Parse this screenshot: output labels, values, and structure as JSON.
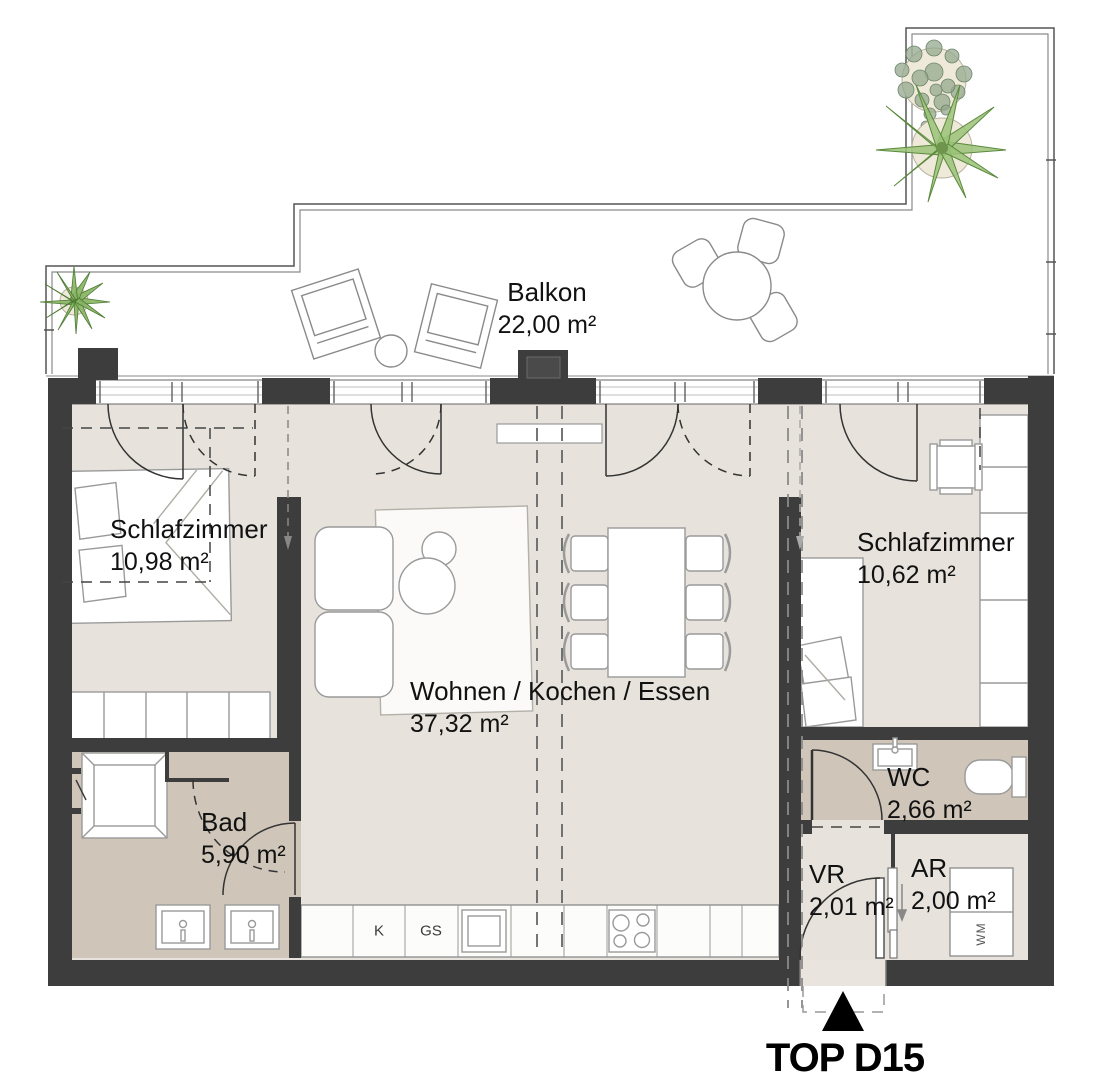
{
  "plan": {
    "unit_label": "TOP D15",
    "rooms": {
      "balkon": {
        "name": "Balkon",
        "area": "22,00 m²"
      },
      "schlafzimmer1": {
        "name": "Schlafzimmer",
        "area": "10,98 m²"
      },
      "wohnen": {
        "name": "Wohnen / Kochen / Essen",
        "area": "37,32 m²"
      },
      "schlafzimmer2": {
        "name": "Schlafzimmer",
        "area": "10,62 m²"
      },
      "bad": {
        "name": "Bad",
        "area": "5,90 m²"
      },
      "wc": {
        "name": "WC",
        "area": "2,66 m²"
      },
      "vr": {
        "name": "VR",
        "area": "2,01 m²"
      },
      "ar": {
        "name": "AR",
        "area": "2,00 m²"
      }
    },
    "kitchen": {
      "fridge_label": "K",
      "dishwasher_label": "GS"
    },
    "appliances": {
      "washing_machine_label": "WM"
    },
    "colors": {
      "wall": "#3d3d3d",
      "floor": "#e7e3dc",
      "wet_floor": "#cfc6b9",
      "plant": "#86b463"
    }
  }
}
